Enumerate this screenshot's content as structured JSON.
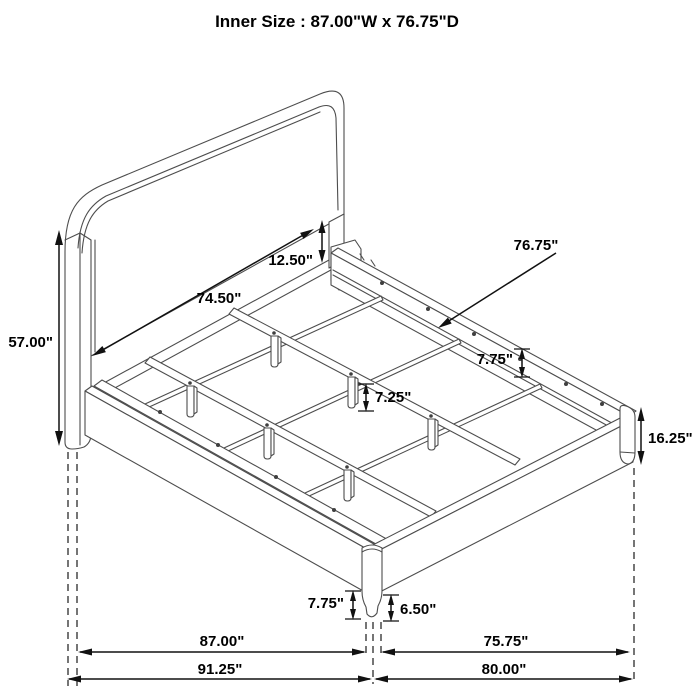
{
  "page": {
    "background": "#ffffff",
    "line_color": "#4d4d4d",
    "dimension_color": "#111111"
  },
  "title": "Inner Size : 87.00\"W x 76.75\"D",
  "dimensions": {
    "overall_height": "57.00\"",
    "headboard_inner_width": "74.50\"",
    "headboard_panel_gap": "12.50\"",
    "slat_support_depth": "76.75\"",
    "side_rail_height": "7.75\"",
    "center_leg_height": "7.25\"",
    "footboard_corner_height": "16.25\"",
    "corner_leg_height": "7.75\"",
    "corner_leg_lower_height": "6.50\"",
    "inner_width": "87.00\"",
    "inner_depth_floor": "75.75\"",
    "overall_width": "91.25\"",
    "overall_depth": "80.00\""
  }
}
